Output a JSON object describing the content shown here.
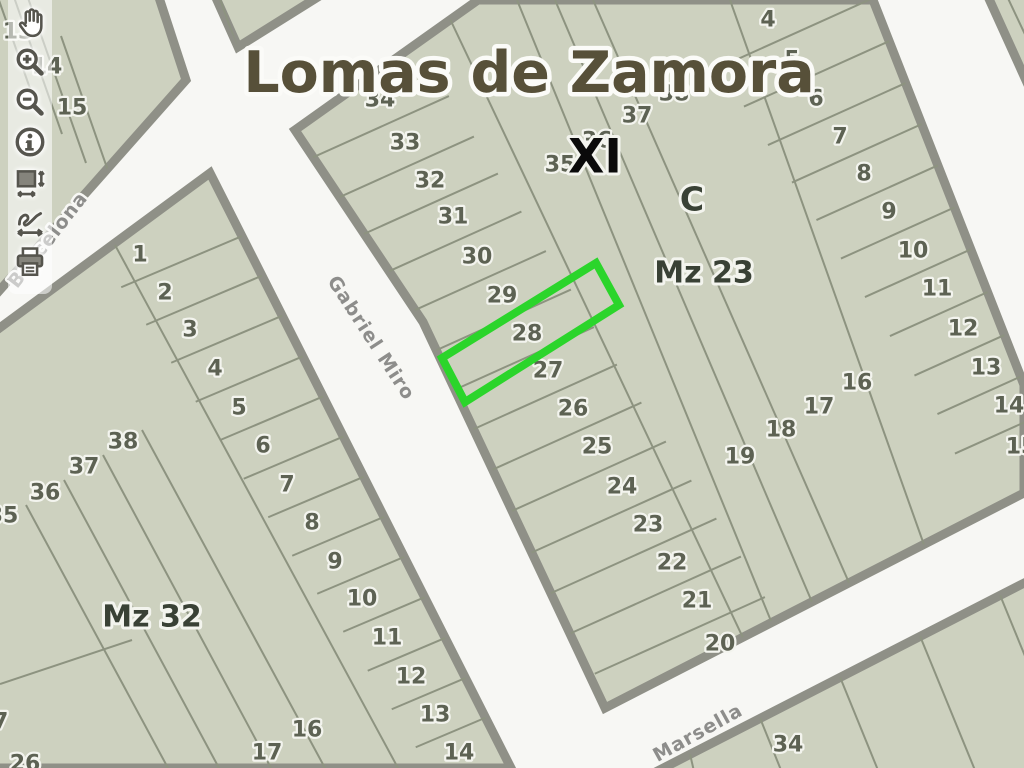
{
  "title": {
    "text": "Lomas de Zamora"
  },
  "toolbar": {
    "buttons": [
      {
        "id": "pan",
        "icon": "pan-hand-icon",
        "tooltip": "Pan"
      },
      {
        "id": "zoom-in",
        "icon": "zoom-in-icon",
        "tooltip": "Zoom in"
      },
      {
        "id": "zoom-out",
        "icon": "zoom-out-icon",
        "tooltip": "Zoom out"
      },
      {
        "id": "identify",
        "icon": "info-icon",
        "tooltip": "Identify"
      },
      {
        "id": "full-extent",
        "icon": "full-extent-icon",
        "tooltip": "Full extent"
      },
      {
        "id": "previous-extent",
        "icon": "previous-extent-icon",
        "tooltip": "Previous extent"
      },
      {
        "id": "print",
        "icon": "print-icon",
        "tooltip": "Print"
      }
    ]
  },
  "map": {
    "colors": {
      "street_bg": "#f7f7f4",
      "block_fill": "#cdd1bf",
      "block_stroke": "#8f9087",
      "lot_line": "#8d9380",
      "lot_number": "#5d6253",
      "halo": "#f3f4ee",
      "title_fill": "#575039",
      "section_fill": "#0a0a0a",
      "area_fill": "#394135",
      "street_label": "#8d8d8b",
      "highlight": "#2bd52b"
    },
    "title": {
      "text": "Lomas de Zamora",
      "x": 529,
      "y": 73,
      "size": 57
    },
    "area_labels": [
      {
        "text": "XI",
        "x": 595,
        "y": 157,
        "size": 47,
        "kind": "section"
      },
      {
        "text": "C",
        "x": 692,
        "y": 199,
        "size": 33,
        "kind": "area"
      },
      {
        "text": "Mz 23",
        "x": 704,
        "y": 273,
        "size": 30,
        "kind": "area"
      },
      {
        "text": "Mz 32",
        "x": 152,
        "y": 617,
        "size": 30,
        "kind": "area"
      }
    ],
    "street_labels": [
      {
        "text": "Barcelona",
        "x": 48,
        "y": 240,
        "rotate": -52,
        "size": 19
      },
      {
        "text": "Gabriel Miro",
        "x": 371,
        "y": 338,
        "rotate": 57,
        "size": 19
      },
      {
        "text": "Marsella",
        "x": 698,
        "y": 733,
        "rotate": -29,
        "size": 19
      }
    ],
    "blocks": [
      {
        "name": "block-top-left",
        "polygon": [
          [
            -20,
            -30
          ],
          [
            150,
            -30
          ],
          [
            186,
            80
          ],
          [
            -40,
            335
          ]
        ],
        "lines": [
          [
            -18,
            -48,
            33,
            97
          ],
          [
            9,
            -17,
            62,
            134
          ],
          [
            28,
            -2,
            86,
            163
          ],
          [
            61,
            36,
            120,
            205
          ]
        ],
        "lots": [
          [
            "13",
            18,
            32
          ],
          [
            "14",
            47,
            67
          ],
          [
            "15",
            72,
            108
          ]
        ],
        "columns": []
      },
      {
        "name": "block-top-center",
        "polygon": [
          [
            208,
            -20
          ],
          [
            238,
            47
          ],
          [
            345,
            -20
          ]
        ],
        "lines": [
          [
            214,
            -18,
            236,
            44
          ]
        ],
        "lots": [],
        "columns": []
      },
      {
        "name": "block-mz-32",
        "polygon": [
          [
            210,
            173
          ],
          [
            511,
            768
          ],
          [
            -310,
            768
          ],
          [
            -310,
            556
          ]
        ],
        "lines": [
          [
            115,
            245,
            398,
            768
          ],
          [
            142,
            430,
            325,
            768
          ],
          [
            103,
            455,
            271,
            768
          ],
          [
            64,
            480,
            219,
            768
          ],
          [
            26,
            505,
            168,
            768
          ],
          [
            0,
            684,
            132,
            640
          ]
        ],
        "lots": [
          [
            "38",
            123,
            442
          ],
          [
            "37",
            84,
            467
          ],
          [
            "36",
            45,
            493
          ],
          [
            "35",
            3,
            516
          ],
          [
            "27",
            -7,
            722
          ],
          [
            "26",
            25,
            764
          ],
          [
            "16",
            307,
            730
          ],
          [
            "17",
            267,
            753
          ]
        ],
        "columns": [
          {
            "dir": [
              0.92,
              -0.39
            ],
            "ext_street": 140,
            "ext_in": 34,
            "lots": [
              [
                "1",
                140,
                255
              ],
              [
                "2",
                165,
                293
              ],
              [
                "3",
                190,
                330
              ],
              [
                "4",
                215,
                369
              ],
              [
                "5",
                239,
                408
              ],
              [
                "6",
                263,
                446
              ],
              [
                "7",
                287,
                485
              ],
              [
                "8",
                312,
                523
              ],
              [
                "9",
                335,
                562
              ],
              [
                "10",
                362,
                599
              ],
              [
                "11",
                387,
                638
              ],
              [
                "12",
                411,
                677
              ],
              [
                "13",
                435,
                715
              ],
              [
                "14",
                459,
                753
              ]
            ]
          }
        ]
      },
      {
        "name": "block-mz-23",
        "polygon": [
          [
            295,
            130
          ],
          [
            478,
            0
          ],
          [
            873,
            0
          ],
          [
            1024,
            385
          ],
          [
            1024,
            493
          ],
          [
            605,
            708
          ],
          [
            423,
            322
          ]
        ],
        "lines": [
          [
            441,
            0,
            763,
            680
          ],
          [
            517,
            0,
            771,
            621
          ],
          [
            555,
            0,
            812,
            602
          ],
          [
            593,
            0,
            850,
            585
          ],
          [
            730,
            0,
            933,
            570
          ]
        ],
        "lots": [
          [
            "38",
            674,
            94
          ],
          [
            "37",
            637,
            116
          ],
          [
            "36",
            597,
            141
          ],
          [
            "35",
            560,
            165
          ],
          [
            "16",
            857,
            383
          ],
          [
            "17",
            819,
            407
          ],
          [
            "18",
            781,
            430
          ],
          [
            "19",
            740,
            457
          ]
        ],
        "columns": [
          {
            "dir": [
              -0.91,
              0.41
            ],
            "ext_street": 125,
            "ext_in": 62,
            "lots": [
              [
                "34",
                380,
                100
              ],
              [
                "33",
                405,
                143
              ],
              [
                "32",
                430,
                181
              ],
              [
                "31",
                453,
                217
              ],
              [
                "30",
                477,
                257
              ],
              [
                "29",
                502,
                296
              ],
              [
                "28",
                527,
                334
              ],
              [
                "27",
                548,
                371
              ],
              [
                "26",
                573,
                409
              ],
              [
                "25",
                597,
                447
              ],
              [
                "24",
                622,
                487
              ],
              [
                "23",
                648,
                525
              ],
              [
                "22",
                672,
                563
              ],
              [
                "21",
                697,
                601
              ],
              [
                "20",
                720,
                644
              ]
            ]
          },
          {
            "dir": [
              0.91,
              -0.41
            ],
            "ext_street": 140,
            "ext_in": 66,
            "lots": [
              [
                "4",
                768,
                20
              ],
              [
                "5",
                792,
                60
              ],
              [
                "6",
                816,
                99
              ],
              [
                "7",
                840,
                137
              ],
              [
                "8",
                864,
                174
              ],
              [
                "9",
                889,
                212
              ],
              [
                "10",
                913,
                251
              ],
              [
                "11",
                937,
                289
              ],
              [
                "12",
                963,
                329
              ],
              [
                "13",
                986,
                368
              ],
              [
                "14",
                1009,
                406
              ],
              [
                "15",
                1021,
                447
              ]
            ]
          }
        ]
      },
      {
        "name": "block-north-east",
        "polygon": [
          [
            985,
            -10
          ],
          [
            1034,
            -10
          ],
          [
            1034,
            98
          ]
        ],
        "lines": [
          [
            1005,
            -8,
            1030,
            45
          ]
        ],
        "lots": [],
        "columns": []
      },
      {
        "name": "block-south-east",
        "polygon": [
          [
            640,
            780
          ],
          [
            1034,
            578
          ],
          [
            1034,
            780
          ]
        ],
        "lines": [
          [
            690,
            754,
            696,
            780
          ],
          [
            760,
            718,
            785,
            780
          ],
          [
            840,
            677,
            882,
            780
          ],
          [
            920,
            636,
            979,
            780
          ],
          [
            1000,
            595,
            1034,
            678
          ]
        ],
        "lots": [
          [
            "34",
            788,
            745
          ]
        ],
        "columns": []
      }
    ],
    "highlight": {
      "name": "highlighted-parcel",
      "polygon": [
        [
          442,
          358
        ],
        [
          596,
          263
        ],
        [
          619,
          305
        ],
        [
          465,
          402
        ]
      ],
      "stroke_width": 8
    }
  }
}
